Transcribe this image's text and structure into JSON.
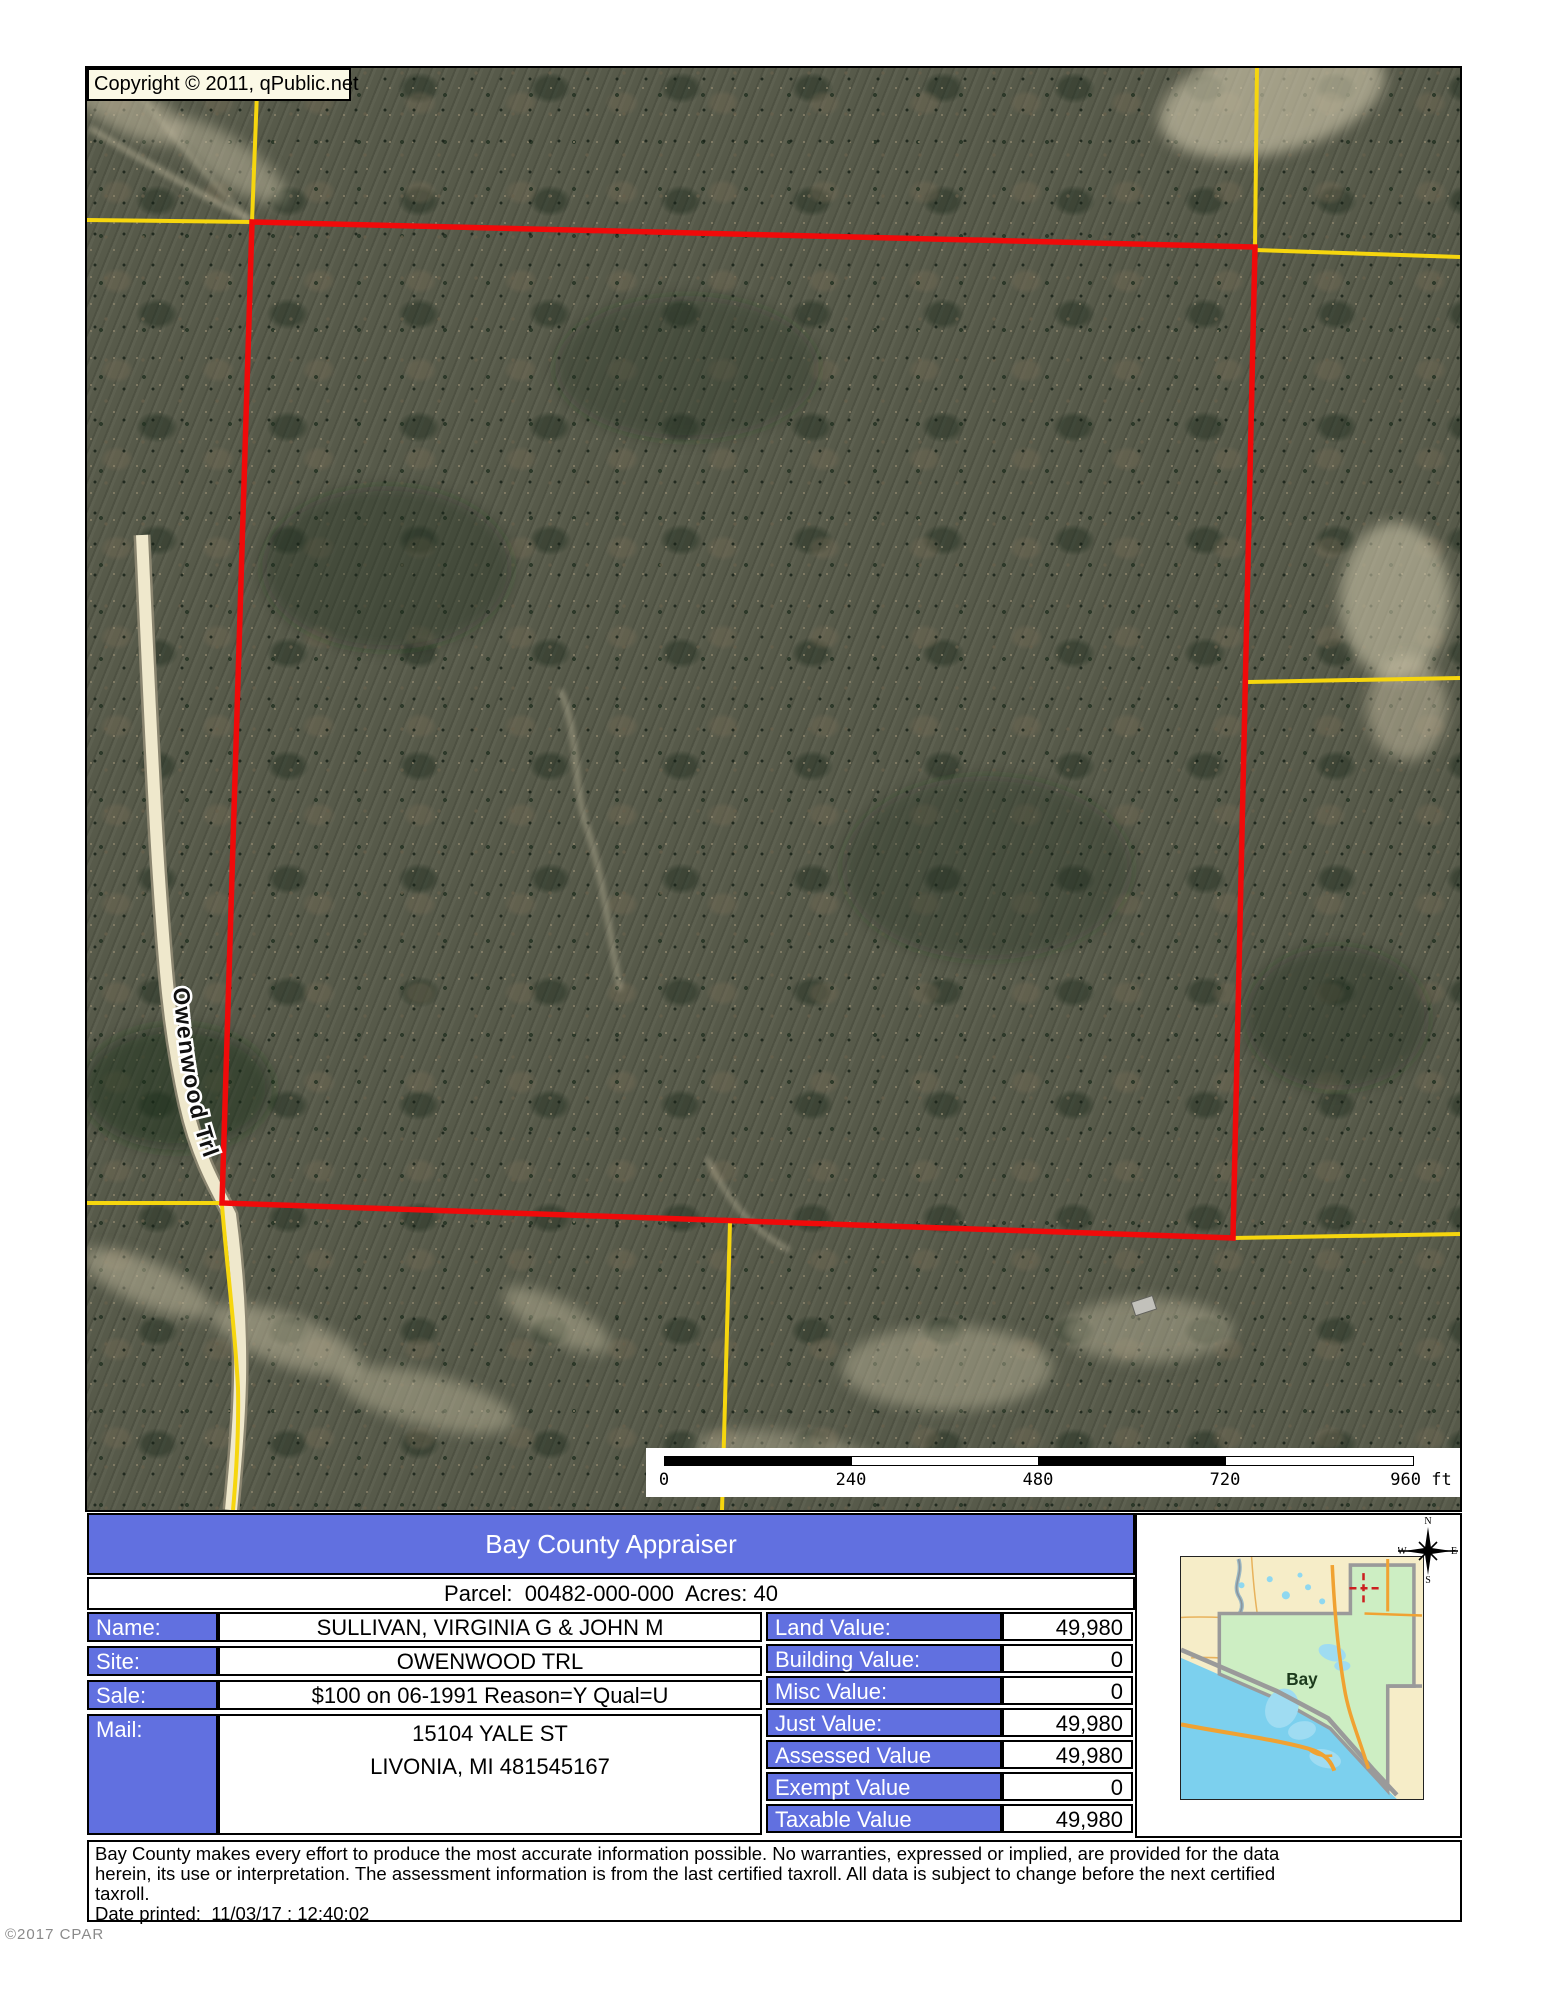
{
  "map": {
    "copyright": "Copyright © 2011, qPublic.net",
    "road_label": "Owenwood Trl",
    "scale_bar": {
      "ticks": [
        "0",
        "240",
        "480",
        "720"
      ],
      "end_label": "960 ft"
    }
  },
  "panel": {
    "title": "Bay County Appraiser",
    "parcel_summary": "Parcel:  00482-000-000  Acres: 40",
    "owner": {
      "name_label": "Name:",
      "name": "SULLIVAN, VIRGINIA G & JOHN M",
      "site_label": "Site:",
      "site": "OWENWOOD TRL",
      "sale_label": "Sale:",
      "sale": "$100 on 06-1991 Reason=Y Qual=U",
      "mail_label": "Mail:",
      "mail_line1": "15104 YALE ST",
      "mail_line2": "LIVONIA, MI 481545167"
    },
    "values": [
      {
        "label": "Land Value:",
        "value": "49,980"
      },
      {
        "label": "Building Value:",
        "value": "0"
      },
      {
        "label": "Misc Value:",
        "value": "0"
      },
      {
        "label": "Just Value:",
        "value": "49,980"
      },
      {
        "label": "Assessed Value",
        "value": "49,980"
      },
      {
        "label": "Exempt Value",
        "value": "0"
      },
      {
        "label": "Taxable Value",
        "value": "49,980"
      }
    ]
  },
  "inset": {
    "county_label": "Bay",
    "compass": {
      "n": "N",
      "s": "S",
      "e": "E",
      "w": "W"
    }
  },
  "disclaimer": {
    "line1": "Bay County makes every effort to produce the most accurate information possible. No warranties, expressed or implied, are provided for the data",
    "line2": "herein, its use or interpretation. The assessment information is from the last certified taxroll. All data is subject to change before the next certified",
    "line3": "taxroll.",
    "date_printed": "Date printed:  11/03/17 : 12:40:02"
  },
  "watermark": "©2017 CPAR",
  "colors": {
    "accent_blue": "#6170e0",
    "boundary_red": "#f00a0a",
    "parcel_yellow": "#f6d60e"
  }
}
